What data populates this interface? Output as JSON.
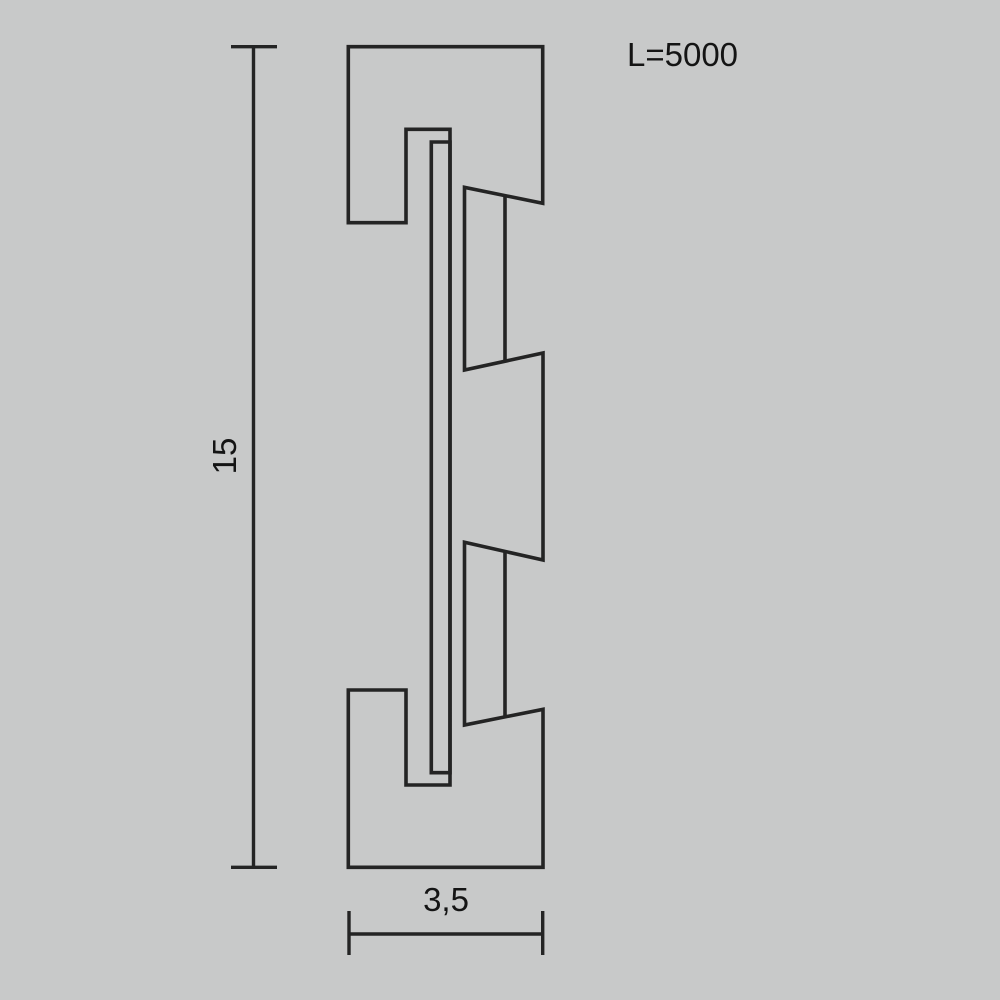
{
  "colors": {
    "background": "#c8c9c9",
    "line": "#242424",
    "text": "#141414"
  },
  "drawing": {
    "kind": "profile-cross-section",
    "length_label": "L=5000",
    "height_dimension": "15",
    "width_dimension": "3,5"
  }
}
